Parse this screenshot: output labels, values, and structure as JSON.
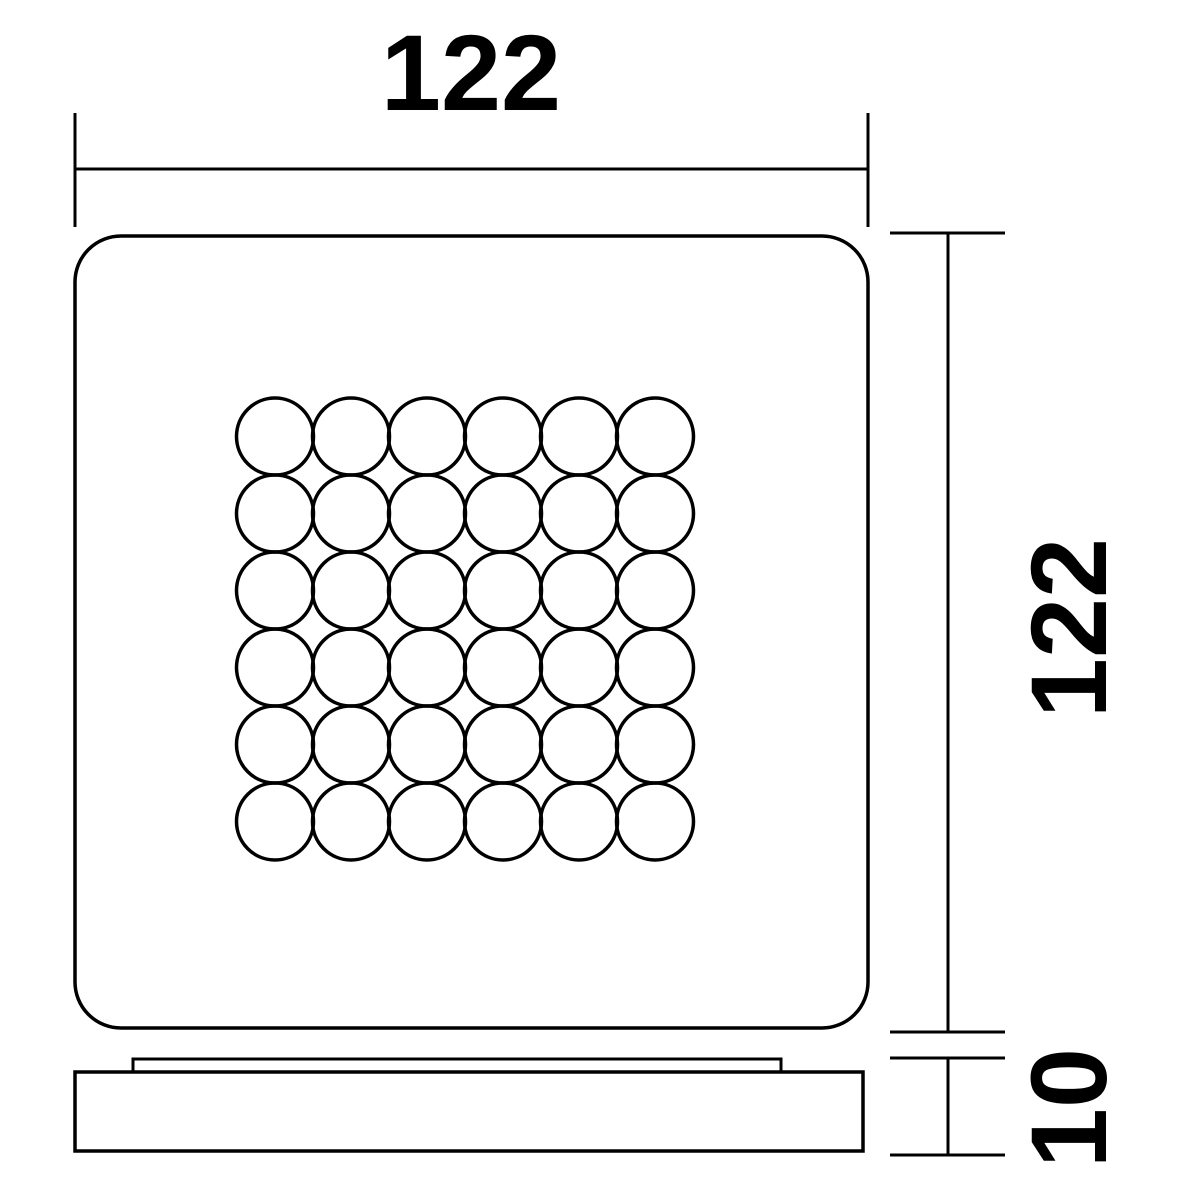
{
  "drawing": {
    "kind": "technical-dimension-drawing",
    "dimensions": {
      "width": {
        "value": "122"
      },
      "height": {
        "value": "122"
      },
      "thickness": {
        "value": "10"
      }
    },
    "led_grid": {
      "rows": 6,
      "cols": 6
    },
    "colors": {
      "line": "#000000",
      "background": "#ffffff"
    }
  }
}
